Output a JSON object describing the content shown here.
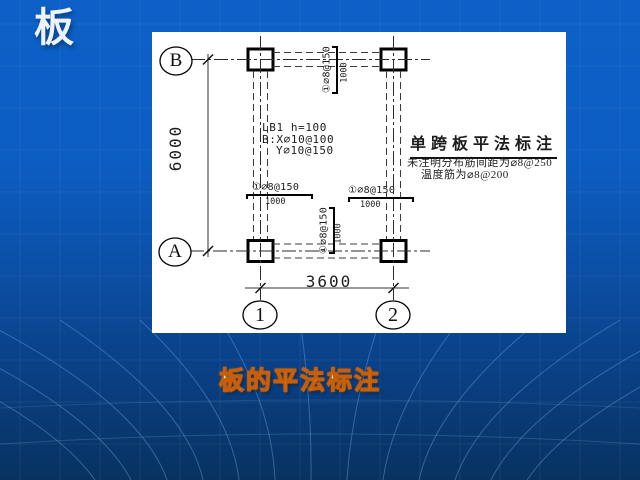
{
  "slide": {
    "title": "板",
    "caption": "板的平法标注"
  },
  "diagram": {
    "axis_bubbles": {
      "row_top": "B",
      "row_bottom": "A",
      "col_left": "1",
      "col_right": "2"
    },
    "dimensions": {
      "vertical": "6000",
      "horizontal": "3600"
    },
    "slab_label": {
      "line1": "LB1  h=100",
      "line2": "B:X⌀10@100",
      "line3": "Y⌀10@150"
    },
    "rebar": {
      "top": {
        "callout": "①⌀8@150",
        "extent": "1000"
      },
      "left": {
        "callout": "①⌀8@150",
        "extent": "1000"
      },
      "right": {
        "callout": "①⌀8@150",
        "extent": "1000"
      },
      "bottom": {
        "callout": "①⌀8@150",
        "extent": "1000"
      }
    },
    "notes": {
      "heading": "单跨板平法标注",
      "line1": "未注明分布筋间距为⌀8@250",
      "line2": "温度筋为⌀8@200"
    }
  },
  "colors": {
    "slide_blue_top": "#0c60c7",
    "slide_blue_bottom": "#083260",
    "caption_orange": "#c85f08",
    "panel_white": "#ffffff",
    "ink": "#1a1a1a"
  }
}
